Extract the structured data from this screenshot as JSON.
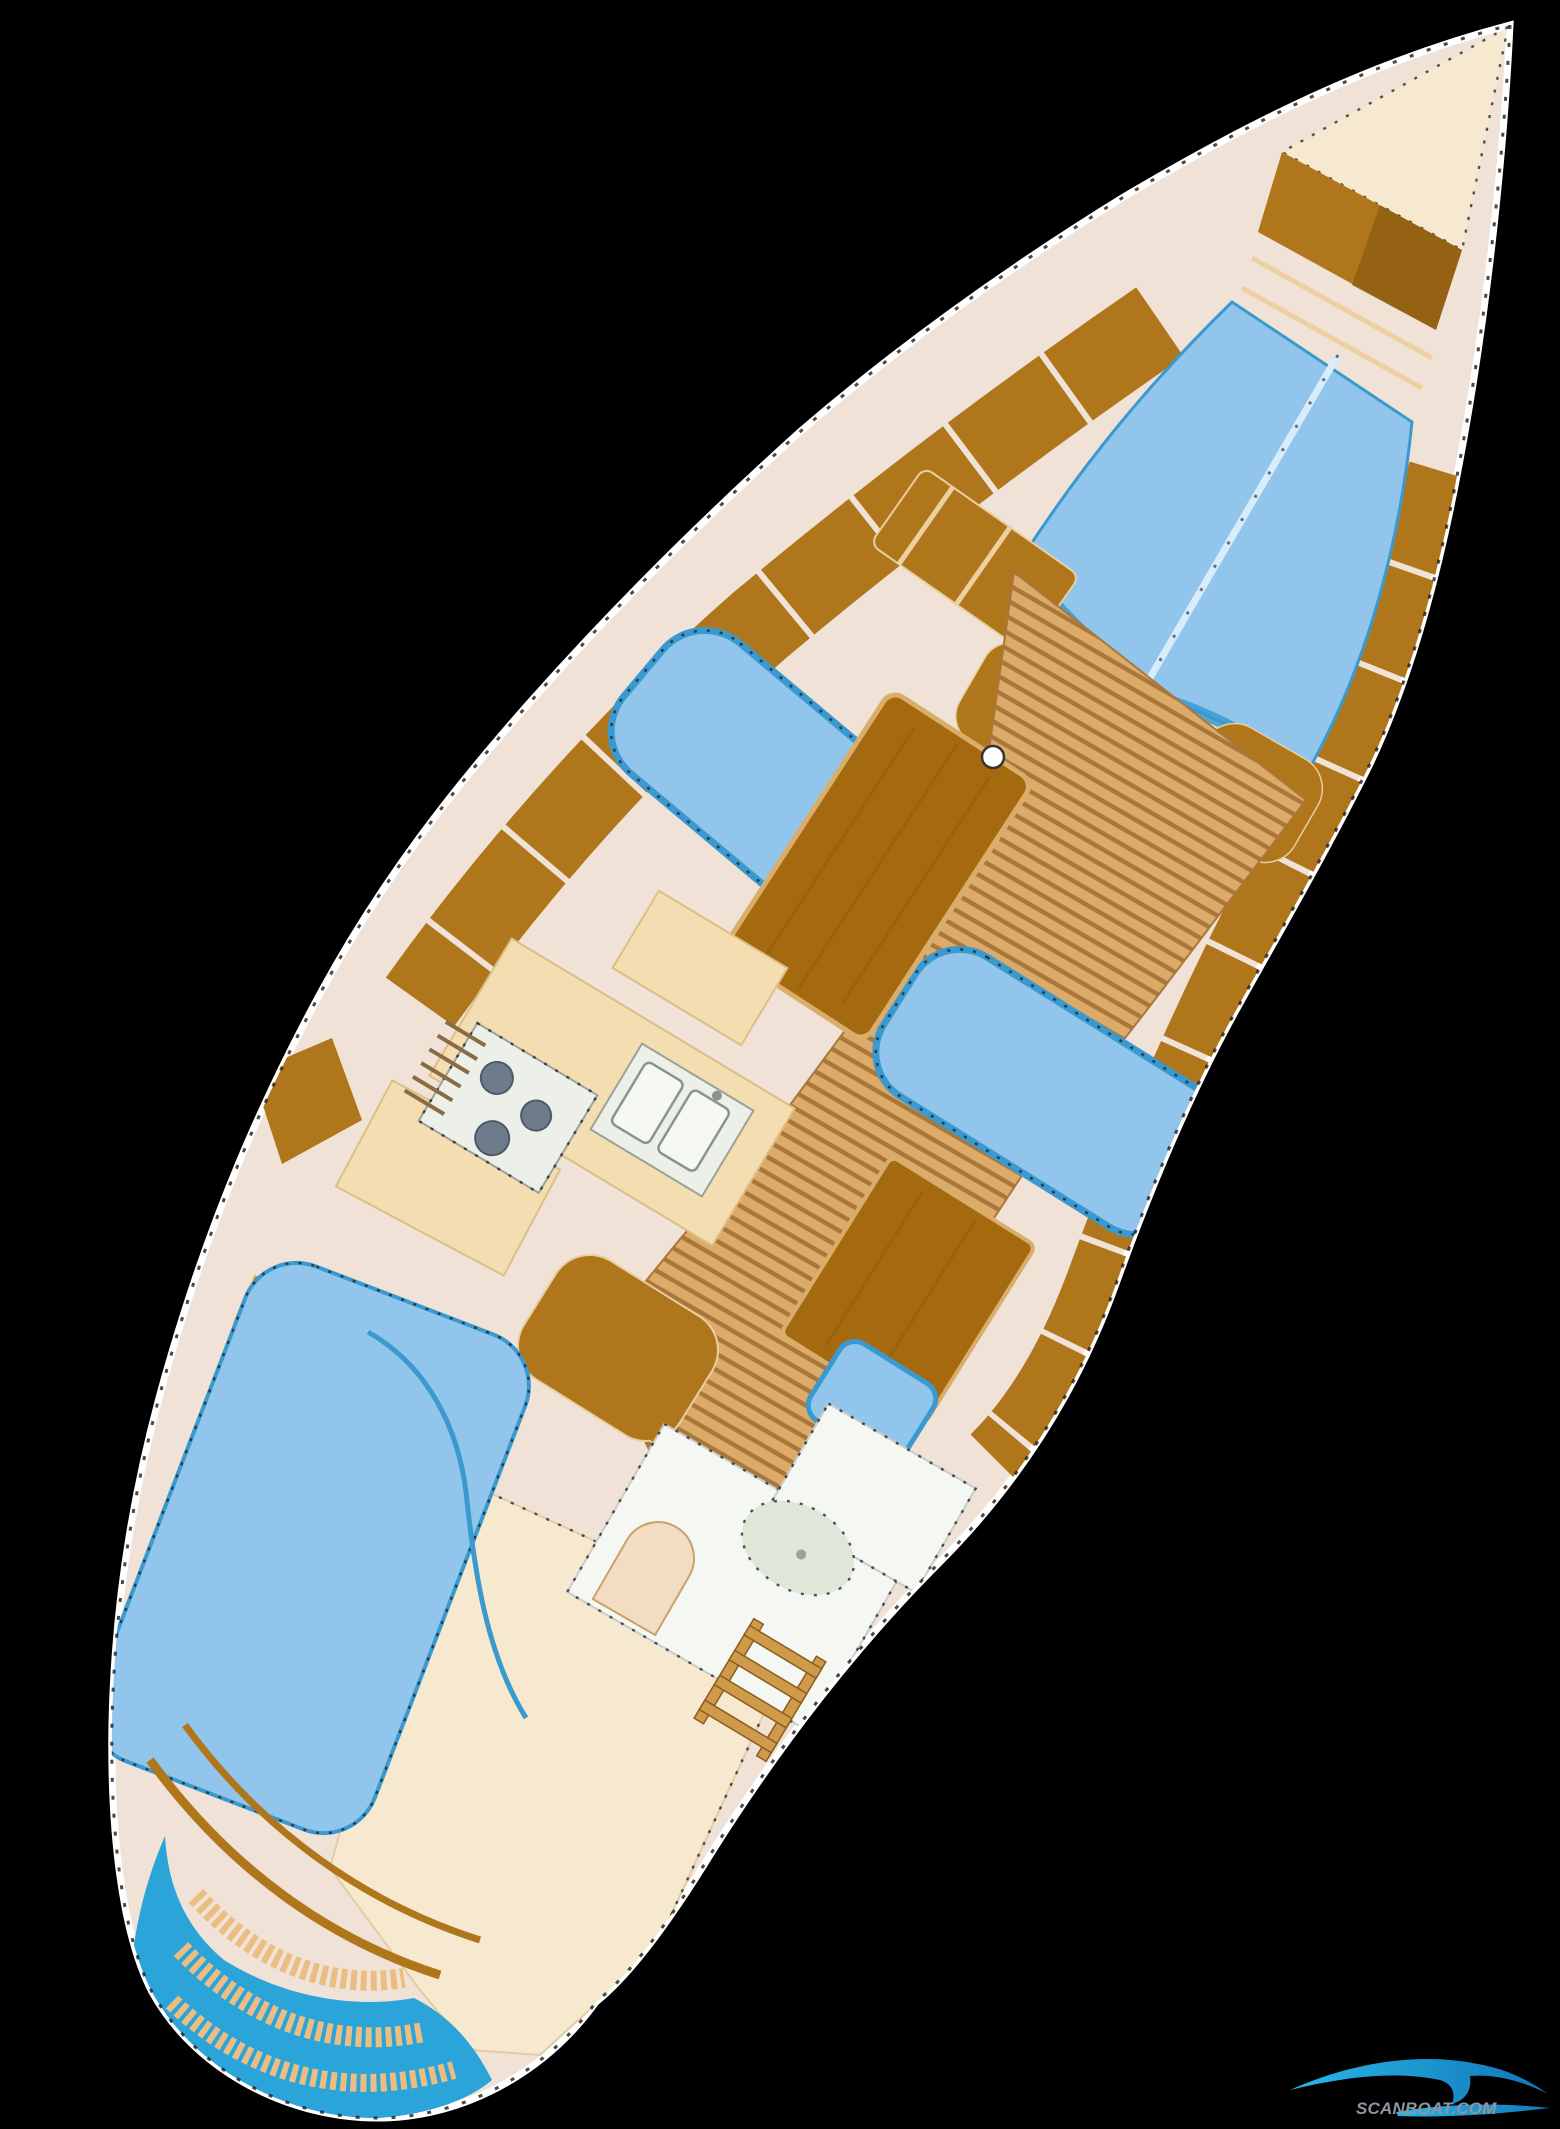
{
  "watermark": {
    "text": "SCANBOAT.COM"
  },
  "palette": {
    "background": "#000000",
    "hull": "#f1e2d8",
    "hull_edge": "#ffffff",
    "outline_dash": "#1c1c1c",
    "bow_deck": "#f7e8d0",
    "wood": "#b0761b",
    "wood_dark": "#8f5c10",
    "wood_divider": "#ecd0a0",
    "wood_light": "#cf9a4a",
    "berth_blue": "#92c5ec",
    "berth_edge": "#3a9ad0",
    "berth_seam": "#d8edfa",
    "teak": "#dcab69",
    "teak_stripe": "#aa773b",
    "table_wood": "#a5690f",
    "table_edge": "#d9ae6b",
    "counter": "#f4ddb0",
    "counter_edge": "#dcbf87",
    "appliance": "#edf0e8",
    "burner": "#6e7b8b",
    "head_floor": "#f5f7f3",
    "shower_tray": "#dfe8d8",
    "toilet": "#f2dcc2",
    "transom_blue": "#2ba4da",
    "step_tan": "#eabd82",
    "watermark_gray": "#8f969f",
    "wave_cyan": "#29b6e8",
    "wave_deep": "#1176b8"
  }
}
